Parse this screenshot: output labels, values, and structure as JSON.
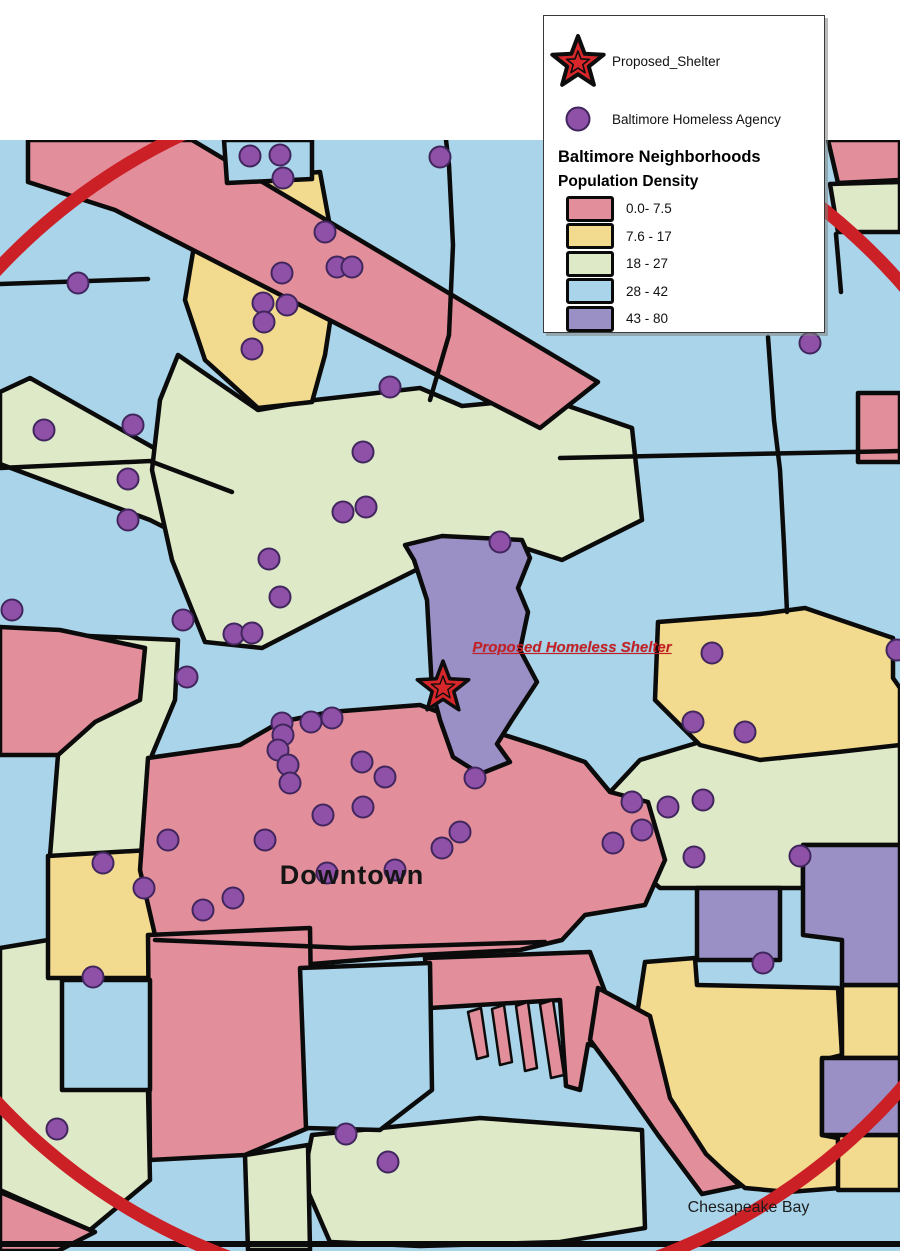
{
  "canvas": {
    "width": 900,
    "height": 1251,
    "map_top": 140
  },
  "legend": {
    "proposed_shelter_label": "Proposed_Shelter",
    "agency_label": "Baltimore Homeless Agency",
    "title": "Baltimore Neighborhoods",
    "subtitle": "Population Density",
    "classes": [
      {
        "label": "0.0- 7.5",
        "color": "#E28F9B"
      },
      {
        "label": "7.6 - 17",
        "color": "#F2DA8E"
      },
      {
        "label": "18 - 27",
        "color": "#DEE9C8"
      },
      {
        "label": "28 - 42",
        "color": "#A9D4E9"
      },
      {
        "label": "43 - 80",
        "color": "#9A90C6"
      }
    ],
    "star_color": "#D8272B",
    "dot_color": "#8F51A8"
  },
  "map": {
    "palette": {
      "P": "#E28F9B",
      "Y": "#F2DA8E",
      "G": "#DEE9C8",
      "B": "#A9D4E9",
      "V": "#9A90C6"
    },
    "boundary_color": "#0b0b0b",
    "water_base_class": "B",
    "labels": {
      "proposed_shelter": {
        "text": "Proposed Homeless Shelter",
        "color": "#C32026"
      },
      "downtown": {
        "text": "Downtown",
        "color": "#151515"
      },
      "chesapeake_bay": {
        "text": "Chesapeake Bay",
        "color": "#1c1c1c"
      }
    },
    "ring": {
      "cx": 443,
      "cy": 686,
      "r": 610,
      "color": "#CC2027",
      "width": 13
    },
    "star": {
      "x": 443,
      "y": 688,
      "size": 27,
      "color": "#D8272B"
    },
    "dot_style": {
      "r": 10.5,
      "fill": "#8F51A8",
      "stroke": "#41265E"
    },
    "regions": [
      {
        "name": "green-band-west",
        "cls": "G",
        "pts": "0,392 30,378 232,492 352,548 332,612 150,520 0,464"
      },
      {
        "name": "green-center",
        "cls": "G",
        "pts": "178,355 258,410 315,400 420,388 462,406 545,398 632,428 642,520 562,560 500,540 432,562 332,612 262,648 205,642 172,560 152,470 160,400"
      },
      {
        "name": "green-east-strip",
        "cls": "G",
        "pts": "830,184 900,182 900,232 838,232"
      },
      {
        "name": "green-tall-west",
        "cls": "G",
        "pts": "88,636 178,640 175,700 152,755 150,856 50,856 58,755 95,722"
      },
      {
        "name": "green-southeast",
        "cls": "G",
        "pts": "612,790 640,760 700,742 780,758 840,748 900,742 900,845 803,845 803,888 660,888 628,860"
      },
      {
        "name": "green-southwest",
        "cls": "G",
        "pts": "0,948 60,938 148,945 148,1090 150,1180 90,1230 0,1190"
      },
      {
        "name": "green-south-mid",
        "cls": "G",
        "pts": "312,1135 480,1118 642,1130 645,1228 560,1242 420,1246 330,1242 303,1180"
      },
      {
        "name": "green-south-wedge",
        "cls": "G",
        "pts": "245,1155 308,1145 310,1250 248,1250"
      },
      {
        "name": "yellow-north",
        "cls": "Y",
        "pts": "200,182 320,172 338,270 325,355 312,402 258,408 205,360 185,300 195,240"
      },
      {
        "name": "yellow-east",
        "cls": "Y",
        "pts": "658,622 760,614 805,608 893,638 893,678 900,688 900,745 838,752 760,760 700,745 655,700"
      },
      {
        "name": "yellow-west-block",
        "cls": "Y",
        "pts": "48,856 150,850 172,898 232,945 232,978 48,978"
      },
      {
        "name": "yellow-southeast-big",
        "cls": "Y",
        "pts": "645,962 695,958 697,985 838,988 842,1055 822,1060 822,1135 838,1138 840,1188 788,1192 745,1188 708,1158 678,1118 650,1065 638,1008"
      },
      {
        "name": "yellow-east-strip-1",
        "cls": "Y",
        "pts": "842,985 900,985 900,1058 842,1058"
      },
      {
        "name": "yellow-east-strip-2",
        "cls": "Y",
        "pts": "838,1135 900,1135 900,1190 838,1190"
      },
      {
        "name": "pink-northwest-band",
        "cls": "P",
        "pts": "28,140 192,140 598,382 540,428 115,210 28,182"
      },
      {
        "name": "pink-northeast",
        "cls": "P",
        "pts": "828,140 900,140 900,180 838,183"
      },
      {
        "name": "pink-east-small",
        "cls": "P",
        "pts": "858,393 900,393 900,462 858,462"
      },
      {
        "name": "pink-west-mid",
        "cls": "P",
        "pts": "0,627 60,630 145,648 140,700 95,722 58,755 0,755"
      },
      {
        "name": "pink-downtown",
        "cls": "P",
        "pts": "148,758 240,745 280,722 330,712 420,705 470,724 545,748 585,762 610,792 648,802 665,860 645,905 585,915 562,940 520,950 420,955 300,965 200,960 155,935 140,870"
      },
      {
        "name": "pink-south-col",
        "cls": "P",
        "pts": "148,935 310,928 312,1062 308,1128 245,1155 150,1160"
      },
      {
        "name": "pink-peninsula",
        "cls": "P",
        "pts": "425,958 590,952 612,1010 600,1048 588,1044 580,1090 566,1086 560,1000 430,1008"
      },
      {
        "name": "pink-pier-1",
        "cls": "P",
        "sw": 2.5,
        "pts": "468,1012 481,1008 488,1056 477,1059"
      },
      {
        "name": "pink-pier-2",
        "cls": "P",
        "sw": 2.5,
        "pts": "492,1009 504,1005 512,1062 500,1065"
      },
      {
        "name": "pink-pier-3",
        "cls": "P",
        "sw": 2.5,
        "pts": "516,1006 528,1002 537,1068 525,1071"
      },
      {
        "name": "pink-pier-4",
        "cls": "P",
        "sw": 2.5,
        "pts": "540,1004 553,1000 564,1075 551,1078"
      },
      {
        "name": "pink-harbor-east-wedge",
        "cls": "P",
        "pts": "598,988 650,1016 670,1098 706,1154 740,1186 702,1194 658,1135 616,1075 590,1040"
      },
      {
        "name": "pink-southwest-corner",
        "cls": "P",
        "pts": "0,1192 95,1232 58,1251 0,1251"
      },
      {
        "name": "blue-pocket-north",
        "cls": "B",
        "pts": "224,140 312,140 312,179 227,183"
      },
      {
        "name": "blue-pocket-west",
        "cls": "B",
        "pts": "62,980 150,980 150,1090 62,1090"
      },
      {
        "name": "blue-harbor-inlet",
        "cls": "B",
        "pts": "300,968 430,963 432,1090 380,1130 306,1128"
      },
      {
        "name": "purple-center",
        "cls": "V",
        "pts": "405,545 442,536 522,540 530,558 518,588 528,612 520,650 537,682 512,720 497,744 510,762 480,774 453,757 440,720 432,690 427,600 414,560"
      },
      {
        "name": "purple-east-rect",
        "cls": "V",
        "pts": "697,888 780,888 780,960 697,960"
      },
      {
        "name": "purple-east-big",
        "cls": "V",
        "pts": "803,845 900,845 900,985 842,985 842,940 803,935"
      },
      {
        "name": "purple-east-patch",
        "cls": "V",
        "pts": "822,1058 900,1058 900,1135 822,1135"
      }
    ],
    "boundary_lines": [
      {
        "pts": "446,140 449,165 453,245 449,335 430,400"
      },
      {
        "pts": "768,337 774,420 780,470 784,545 787,612"
      },
      {
        "pts": "560,458 700,455 900,451"
      },
      {
        "pts": "0,284 148,279"
      },
      {
        "pts": "0,468 150,461 232,492"
      },
      {
        "pts": "836,234 841,292"
      },
      {
        "pts": "155,940 350,948 545,942"
      },
      {
        "pts": "636,140 640,168"
      },
      {
        "pts": "0,1244 900,1244",
        "w": 6
      }
    ],
    "agency_dots": [
      [
        250,
        156
      ],
      [
        280,
        155
      ],
      [
        283,
        178
      ],
      [
        440,
        157
      ],
      [
        325,
        232
      ],
      [
        337,
        267
      ],
      [
        352,
        267
      ],
      [
        282,
        273
      ],
      [
        263,
        303
      ],
      [
        287,
        305
      ],
      [
        264,
        322
      ],
      [
        252,
        349
      ],
      [
        810,
        343
      ],
      [
        78,
        283
      ],
      [
        44,
        430
      ],
      [
        133,
        425
      ],
      [
        128,
        479
      ],
      [
        128,
        520
      ],
      [
        12,
        610
      ],
      [
        390,
        387
      ],
      [
        363,
        452
      ],
      [
        343,
        512
      ],
      [
        366,
        507
      ],
      [
        269,
        559
      ],
      [
        280,
        597
      ],
      [
        500,
        542
      ],
      [
        183,
        620
      ],
      [
        234,
        634
      ],
      [
        252,
        633
      ],
      [
        187,
        677
      ],
      [
        282,
        723
      ],
      [
        311,
        722
      ],
      [
        332,
        718
      ],
      [
        283,
        735
      ],
      [
        278,
        750
      ],
      [
        288,
        765
      ],
      [
        290,
        783
      ],
      [
        362,
        762
      ],
      [
        385,
        777
      ],
      [
        363,
        807
      ],
      [
        323,
        815
      ],
      [
        265,
        840
      ],
      [
        168,
        840
      ],
      [
        460,
        832
      ],
      [
        442,
        848
      ],
      [
        475,
        778
      ],
      [
        395,
        870
      ],
      [
        327,
        873
      ],
      [
        233,
        898
      ],
      [
        203,
        910
      ],
      [
        712,
        653
      ],
      [
        693,
        722
      ],
      [
        745,
        732
      ],
      [
        897,
        650
      ],
      [
        632,
        802
      ],
      [
        668,
        807
      ],
      [
        703,
        800
      ],
      [
        642,
        830
      ],
      [
        613,
        843
      ],
      [
        694,
        857
      ],
      [
        800,
        856
      ],
      [
        763,
        963
      ],
      [
        103,
        863
      ],
      [
        144,
        888
      ],
      [
        93,
        977
      ],
      [
        57,
        1129
      ],
      [
        346,
        1134
      ],
      [
        388,
        1162
      ]
    ]
  }
}
